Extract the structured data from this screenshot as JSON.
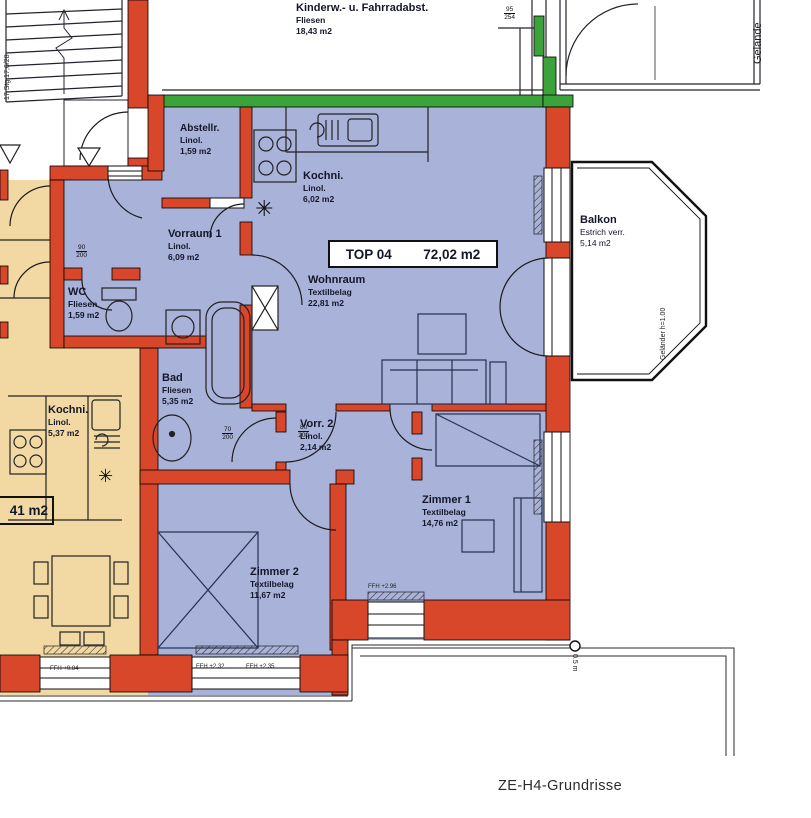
{
  "unit": {
    "id": "TOP 04",
    "area": "72,02 m2"
  },
  "neighbor": {
    "area": "41 m2"
  },
  "title": "ZE-H4-Grundrisse",
  "rooms": {
    "kinderwagen": {
      "name": "Kinderw.- u. Fahrradabst.",
      "floor": "Fliesen",
      "area": "18,43 m2"
    },
    "abstellraum": {
      "name": "Abstellr.",
      "floor": "Linol.",
      "area": "1,59 m2"
    },
    "kueche": {
      "name": "Kochni.",
      "floor": "Linol.",
      "area": "6,02 m2"
    },
    "wohnraum": {
      "name": "Wohnraum",
      "floor": "Textilbelag",
      "area": "22,81 m2"
    },
    "vorraum1": {
      "name": "Vorraum 1",
      "floor": "Linol.",
      "area": "6,09 m2"
    },
    "wc": {
      "name": "WC",
      "floor": "Fliesen",
      "area": "1,59 m2"
    },
    "bad": {
      "name": "Bad",
      "floor": "Fliesen",
      "area": "5,35 m2"
    },
    "vorraum2": {
      "name": "Vorr. 2",
      "floor": "Linol.",
      "area": "2,14 m2"
    },
    "zimmer1": {
      "name": "Zimmer 1",
      "floor": "Textilbelag",
      "area": "14,76 m2"
    },
    "zimmer2": {
      "name": "Zimmer 2",
      "floor": "Textilbelag",
      "area": "11,67 m2"
    },
    "kueche_nachbar": {
      "name": "Kochni.",
      "floor": "Linol.",
      "area": "5,37 m2"
    },
    "balkon": {
      "name": "Balkon",
      "floor": "Estrich verr.",
      "area": "5,14 m2"
    }
  },
  "annotations": {
    "site": "Gelände",
    "railing": "Geländer h=1.00",
    "marker": "0.5 m",
    "stairs": "17 Stg 17,6/28",
    "ffh_left": "FFH +0.84",
    "ffh_z2a": "FFH +2.32",
    "ffh_z2b": "FFH +2.35",
    "ffh_z1": "FFH +2.96"
  },
  "dims": {
    "win_top": {
      "w": "95",
      "h": "254"
    },
    "door_wc": {
      "w": "90",
      "h": "200"
    },
    "door_bad": {
      "w": "70",
      "h": "200"
    },
    "door_vorr2": {
      "w": "80",
      "h": "200"
    }
  },
  "colors": {
    "wall": "#d9472b",
    "unit_fill": "#a9b2d8",
    "neighbor_fill": "#f2d9a4",
    "exterior_wall": "#3ba33a",
    "line": "#1c1c28",
    "text": "#14162a"
  }
}
